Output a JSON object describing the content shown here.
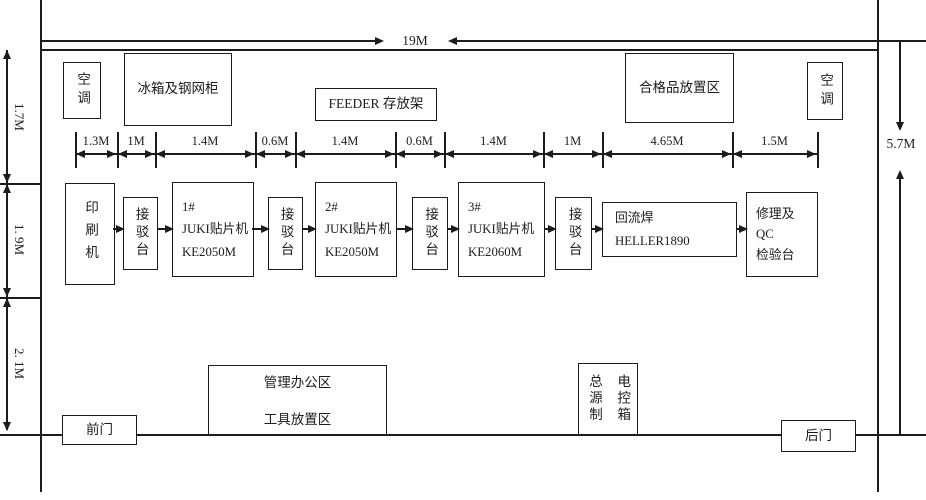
{
  "colors": {
    "line": "#1c1c1c",
    "background": "#ffffff"
  },
  "dimensions": {
    "total_width": "19M",
    "total_height": "5.7M",
    "left_spans": [
      "1.7M",
      "1. 9M",
      "2. 1M"
    ],
    "chain": [
      "1.3M",
      "1M",
      "1.4M",
      "0.6M",
      "1.4M",
      "0.6M",
      "1.4M",
      "1M",
      "4.65M",
      "1.5M"
    ]
  },
  "top_row": {
    "ac_left": "空调",
    "fridge_cabinet": "冰箱及钢网柜",
    "feeder_rack": "FEEDER 存放架",
    "qualified_area": "合格品放置区",
    "ac_right": "空调"
  },
  "line_row": {
    "printer": "印刷机",
    "conveyor": "接驳台",
    "juki1": {
      "no": "1#",
      "name": "JUKI贴片机",
      "model": "KE2050M"
    },
    "juki2": {
      "no": "2#",
      "name": "JUKI贴片机",
      "model": "KE2050M"
    },
    "juki3": {
      "no": "3#",
      "name": "JUKI贴片机",
      "model": "KE2060M"
    },
    "reflow": {
      "name": "回流焊",
      "model": "HELLER1890"
    },
    "repair": {
      "line1": "修理及",
      "line2": "QC",
      "line3": "检验台"
    }
  },
  "bottom_row": {
    "office_line1": "管理办公区",
    "office_line2": "工具放置区",
    "power_box_col1": "总源制",
    "power_box_col2": "电控箱",
    "front_door": "前门",
    "back_door": "后门"
  }
}
